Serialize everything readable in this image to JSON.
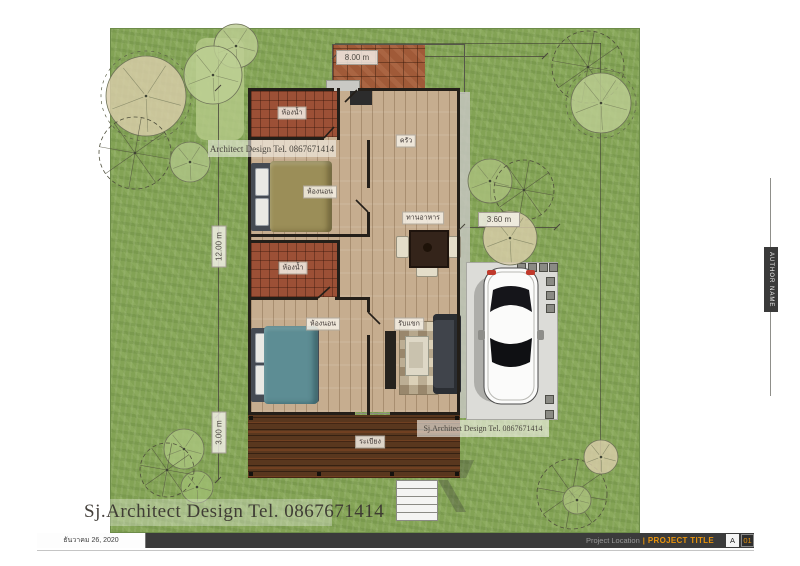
{
  "site": {
    "dimensions": {
      "width": "8.00 m",
      "length": "12.00 m",
      "terrace": "3.00 m",
      "parking": "3.60 m"
    }
  },
  "rooms": {
    "bathroom_top": "ห้องน้ำ",
    "bedroom_top": "ห้องนอน",
    "kitchen": "ครัว",
    "dining": "ทานอาหาร",
    "bathroom_middle": "ห้องน้ำ",
    "bedroom_bottom": "ห้องนอน",
    "living": "รับแขก",
    "terrace": "ระเบียง"
  },
  "watermarks": {
    "upper": "Architect Design Tel. 0867671414",
    "middle": "Sj.Architect Design Tel. 0867671414",
    "bottom": "Sj.Architect Design Tel. 0867671414"
  },
  "titleblock": {
    "date": "ธันวาคม 26, 2020",
    "project_location": "Project Location",
    "divider": "|",
    "project_title": "PROJECT TITLE",
    "sheet_letter": "A",
    "sheet_number": "01",
    "author": "AUTHOR NAME"
  },
  "icons": {
    "trees": "tree-icon",
    "vehicle": "car-icon"
  },
  "colors": {
    "accent_orange": "#e8930c",
    "grass_green": "#83a355",
    "deck_brown": "#59371e",
    "roof_brick": "#a05a38",
    "titlebar_gray": "#3b3b3b"
  }
}
